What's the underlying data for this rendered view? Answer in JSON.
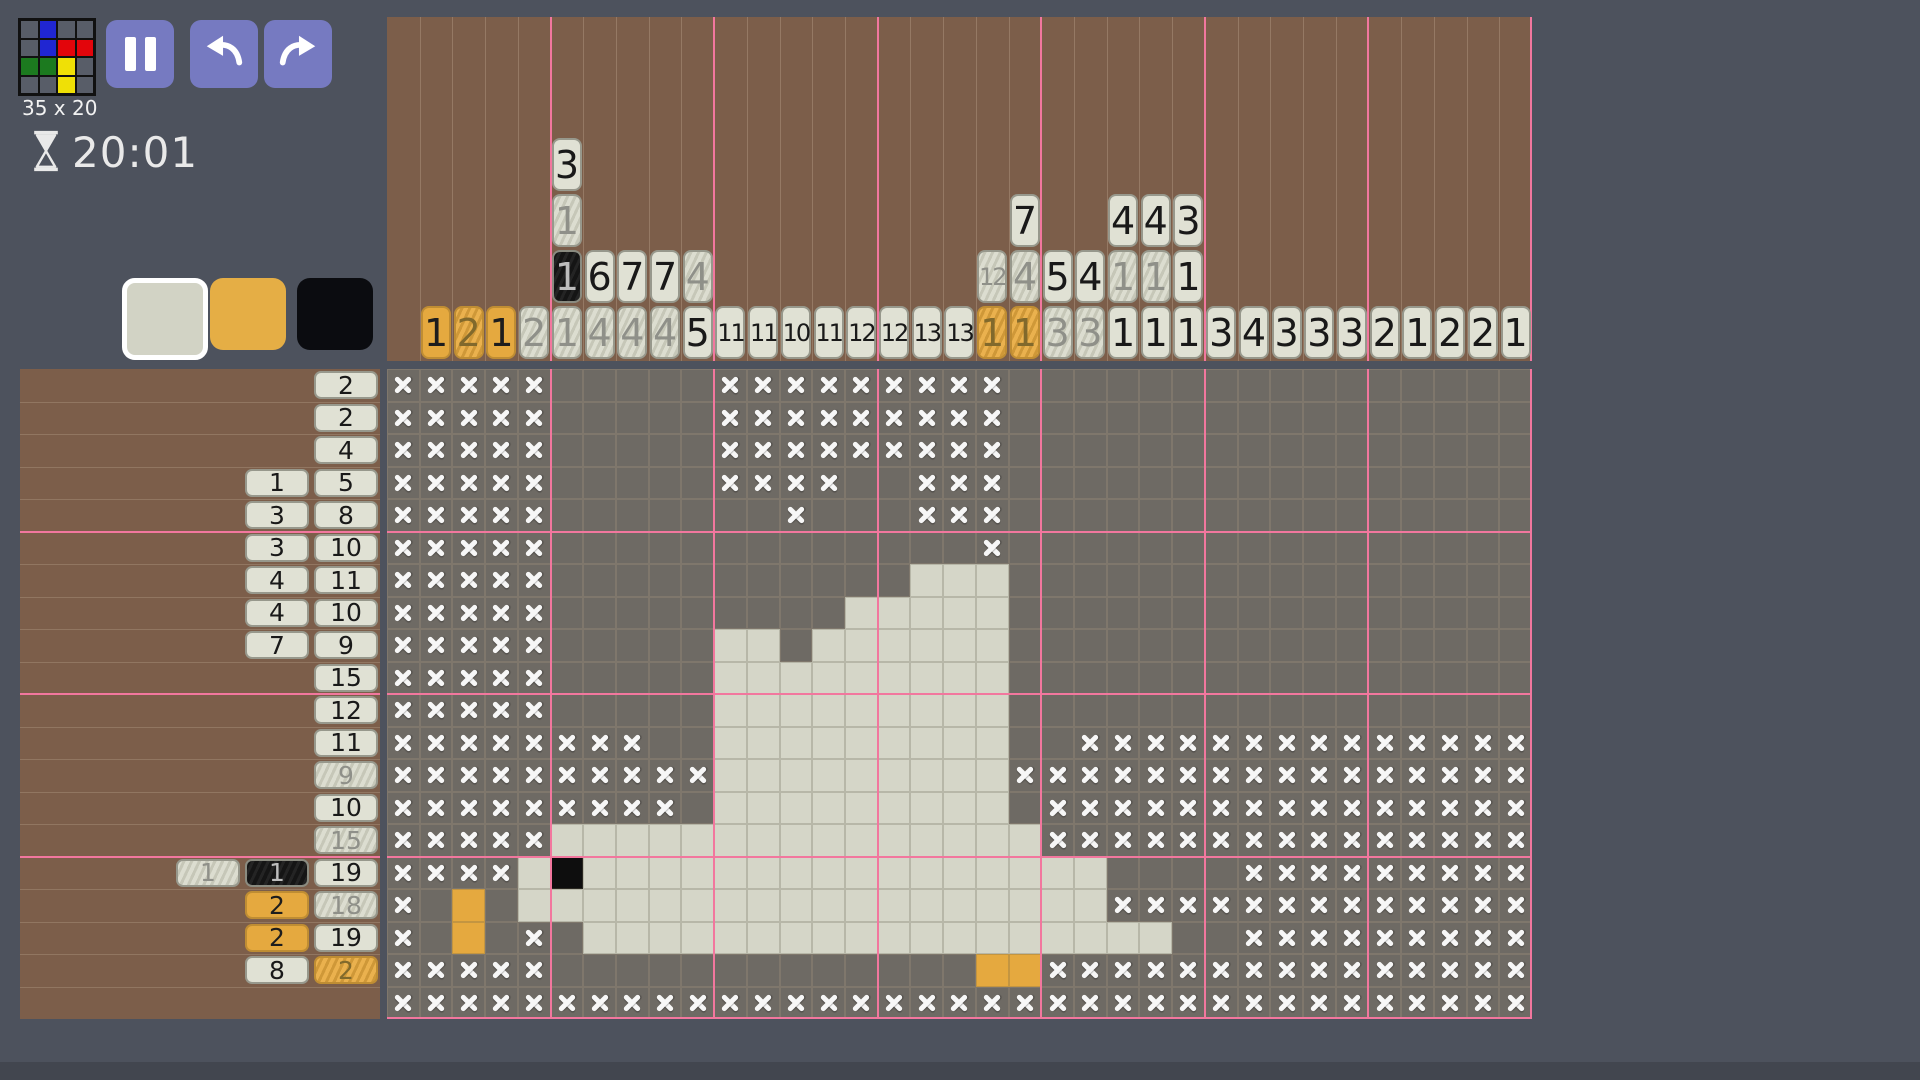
{
  "header": {
    "size_label": "35 x 20",
    "timer": "20:01"
  },
  "toolbar": {
    "buttons": [
      "pause",
      "undo",
      "redo"
    ]
  },
  "logo": {
    "rows": [
      ".b..",
      ".brr",
      "ggy.",
      "..y."
    ],
    "palette": {
      ".": "#585d68",
      "b": "#2026d2",
      "r": "#e3050b",
      "g": "#1c7a1f",
      "y": "#efe006"
    }
  },
  "palette": [
    {
      "name": "white",
      "color": "#d2d3c5",
      "selected": true
    },
    {
      "name": "orange",
      "color": "#e5ae45",
      "selected": false
    },
    {
      "name": "black",
      "color": "#0b0c10",
      "selected": false
    }
  ],
  "puzzle": {
    "cols": 35,
    "rows": 20
  },
  "col_clues": [
    [],
    [
      [
        1,
        "o",
        0
      ]
    ],
    [
      [
        2,
        "o",
        1
      ]
    ],
    [
      [
        1,
        "o",
        0
      ]
    ],
    [
      [
        2,
        "w",
        1
      ]
    ],
    [
      [
        3,
        "w",
        0
      ],
      [
        1,
        "w",
        1
      ],
      [
        1,
        "b",
        1
      ],
      [
        1,
        "w",
        1
      ]
    ],
    [
      [
        6,
        "w",
        0
      ],
      [
        4,
        "w",
        1
      ]
    ],
    [
      [
        7,
        "w",
        0
      ],
      [
        4,
        "w",
        1
      ]
    ],
    [
      [
        7,
        "w",
        0
      ],
      [
        4,
        "w",
        1
      ]
    ],
    [
      [
        4,
        "w",
        1
      ],
      [
        5,
        "w",
        0
      ]
    ],
    [
      [
        11,
        "w",
        0
      ]
    ],
    [
      [
        11,
        "w",
        0
      ]
    ],
    [
      [
        10,
        "w",
        0
      ]
    ],
    [
      [
        11,
        "w",
        0
      ]
    ],
    [
      [
        12,
        "w",
        0
      ]
    ],
    [
      [
        12,
        "w",
        0
      ]
    ],
    [
      [
        13,
        "w",
        0
      ]
    ],
    [
      [
        13,
        "w",
        0
      ]
    ],
    [
      [
        12,
        "w",
        1
      ],
      [
        1,
        "o",
        1
      ]
    ],
    [
      [
        7,
        "w",
        0
      ],
      [
        4,
        "w",
        1
      ],
      [
        1,
        "o",
        1
      ]
    ],
    [
      [
        5,
        "w",
        0
      ],
      [
        3,
        "w",
        1
      ]
    ],
    [
      [
        4,
        "w",
        0
      ],
      [
        3,
        "w",
        1
      ]
    ],
    [
      [
        4,
        "w",
        0
      ],
      [
        1,
        "w",
        1
      ],
      [
        1,
        "w",
        0
      ]
    ],
    [
      [
        4,
        "w",
        0
      ],
      [
        1,
        "w",
        1
      ],
      [
        1,
        "w",
        0
      ]
    ],
    [
      [
        3,
        "w",
        0
      ],
      [
        1,
        "w",
        0
      ],
      [
        1,
        "w",
        0
      ]
    ],
    [
      [
        3,
        "w",
        0
      ]
    ],
    [
      [
        4,
        "w",
        0
      ]
    ],
    [
      [
        3,
        "w",
        0
      ]
    ],
    [
      [
        3,
        "w",
        0
      ]
    ],
    [
      [
        3,
        "w",
        0
      ]
    ],
    [
      [
        2,
        "w",
        0
      ]
    ],
    [
      [
        1,
        "w",
        0
      ]
    ],
    [
      [
        2,
        "w",
        0
      ]
    ],
    [
      [
        2,
        "w",
        0
      ]
    ],
    [
      [
        1,
        "w",
        0
      ]
    ]
  ],
  "row_clues": [
    [
      [
        2,
        "w",
        0
      ]
    ],
    [
      [
        2,
        "w",
        0
      ]
    ],
    [
      [
        4,
        "w",
        0
      ]
    ],
    [
      [
        1,
        "w",
        0
      ],
      [
        5,
        "w",
        0
      ]
    ],
    [
      [
        3,
        "w",
        0
      ],
      [
        8,
        "w",
        0
      ]
    ],
    [
      [
        3,
        "w",
        0
      ],
      [
        10,
        "w",
        0
      ]
    ],
    [
      [
        4,
        "w",
        0
      ],
      [
        11,
        "w",
        0
      ]
    ],
    [
      [
        4,
        "w",
        0
      ],
      [
        10,
        "w",
        0
      ]
    ],
    [
      [
        7,
        "w",
        0
      ],
      [
        9,
        "w",
        0
      ]
    ],
    [
      [
        15,
        "w",
        0
      ]
    ],
    [
      [
        12,
        "w",
        0
      ]
    ],
    [
      [
        11,
        "w",
        0
      ]
    ],
    [
      [
        9,
        "w",
        1
      ]
    ],
    [
      [
        10,
        "w",
        0
      ]
    ],
    [
      [
        15,
        "w",
        1
      ]
    ],
    [
      [
        1,
        "w",
        1
      ],
      [
        1,
        "b",
        1
      ],
      [
        19,
        "w",
        0
      ]
    ],
    [
      [
        2,
        "o",
        0
      ],
      [
        18,
        "w",
        1
      ]
    ],
    [
      [
        2,
        "o",
        0
      ],
      [
        19,
        "w",
        0
      ]
    ],
    [
      [
        8,
        "w",
        0
      ],
      [
        2,
        "o",
        1
      ]
    ],
    []
  ],
  "grid": [
    "xxxxx.....xxxxxxxxx................",
    "xxxxx.....xxxxxxxxx................",
    "xxxxx.....xxxxxxxxx................",
    "xxxxx.....xxxx..xxx................",
    "xxxxx.......x...xxx................",
    "xxxxx.............x................",
    "xxxxx...........WWW................",
    "xxxxx.........WWWWW................",
    "xxxxx.....WW.WWWWWW................",
    "xxxxx.....WWWWWWWWW................",
    "xxxxx.....WWWWWWWWW................",
    "xxxxxxxx..WWWWWWWWW..xxxxxxxxxxxxxx",
    "xxxxxxxxxxWWWWWWWWWxxxxxxxxxxxxxxxx",
    "xxxxxxxxx.WWWWWWWWW.xxxxxxxxxxxxxxx",
    "xxxxxWWWWWWWWWWWWWWWxxxxxxxxxxxxxxx",
    "xxxxWBWWWWWWWWWWWWWWWW....xxxxxxxxx",
    "x.O.WWWWWWWWWWWWWWWWWWxxxxxxxxxxxxx",
    "x.O.x.WWWWWWWWWWWWWWWWWW..xxxxxxxxx",
    "xxxxx.............OOxxxxxxxxxxxxxxx",
    "xxxxxxxxxxxxxxxxxxxxxxxxxxxxxxxxxxx"
  ],
  "colors": {
    "background": "#4d525d",
    "clue_panel": "#7c5e4a",
    "bottom_bar": "#42464f",
    "guide_pink": "#f2779e",
    "cell_empty": "#6e6a64",
    "fill_white": "#d5d6c8",
    "fill_orange": "#e5a93f",
    "fill_black": "#0e0e0e",
    "button": "#767ac1"
  }
}
